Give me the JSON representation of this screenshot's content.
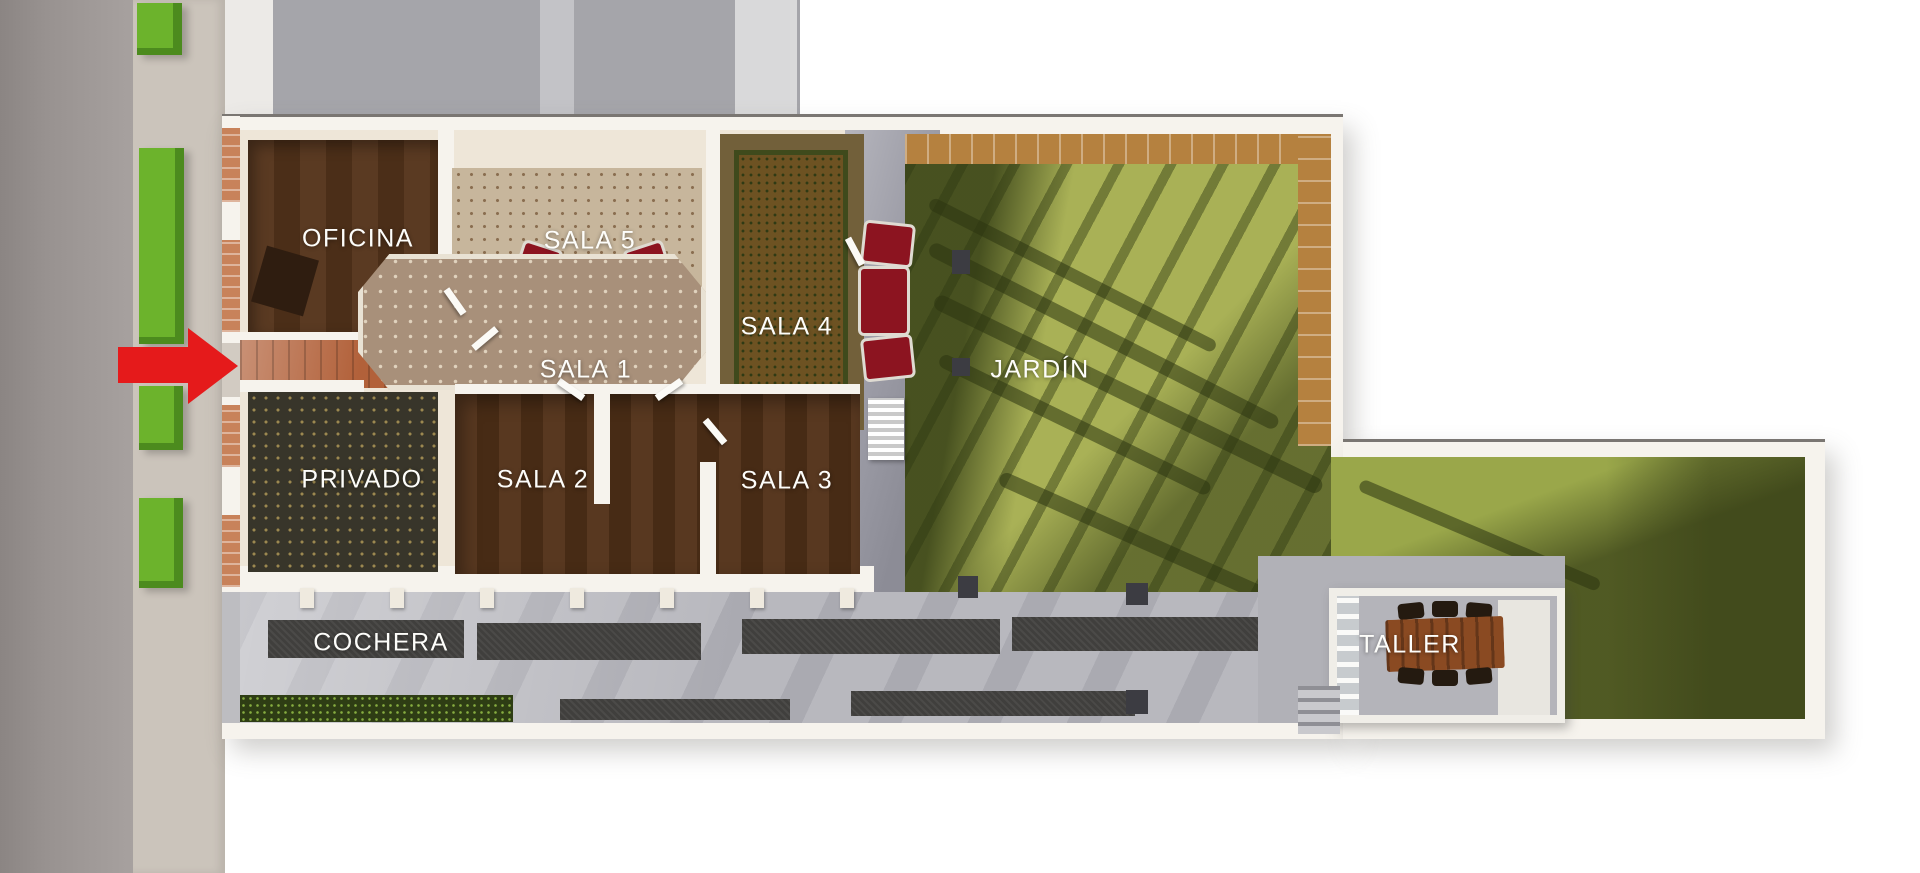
{
  "page": {
    "type": "3d-floor-plan-top-view-render",
    "background": "#ffffff"
  },
  "labels": {
    "oficina": "OFICINA",
    "sala5": "SALA 5",
    "sala4": "SALA 4",
    "sala1": "SALA 1",
    "privado": "PRIVADO",
    "sala2": "SALA 2",
    "sala3": "SALA 3",
    "jardin": "JARDÍN",
    "cochera": "COCHERA",
    "taller": "TALLER"
  },
  "annotations": {
    "entrance_arrow": {
      "icon": "arrow-right-icon",
      "direction": "right",
      "color": "#e51a1b"
    }
  },
  "colors": {
    "street_grey": "#a09a98",
    "sidewalk": "#cbc4bb",
    "planter_green": "#6cb32c",
    "wall_white": "#f6f3ed",
    "grass_lit": "#a9b156",
    "grass_shadow": "#4e5a22",
    "garden_tile_border": "#b5813f",
    "wood_floor": "#54351e",
    "charcoal_band": "#403f3d",
    "hedge_green": "#2e3d14",
    "concrete": "#b8b8be",
    "furniture_red": "#8c1420",
    "arrow_red": "#e51a1b"
  }
}
